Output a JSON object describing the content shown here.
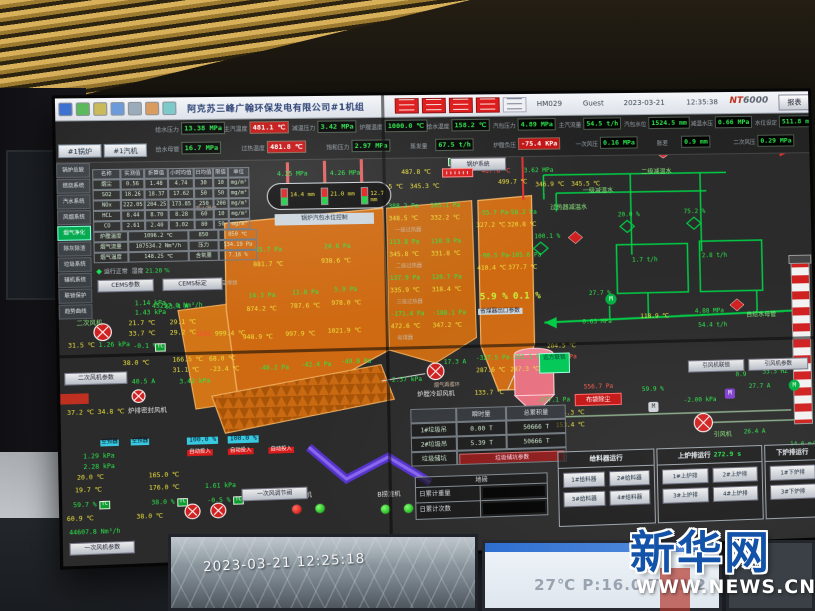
{
  "photo": {
    "camera_timestamp": "2023-03-21 12:25:18",
    "ambient_display": "27℃ P:16.0 T:17.2",
    "watermark_cn": "新华网",
    "watermark_url": "WWW.NEWS.CN"
  },
  "bar": {
    "title": "阿克苏三峰广翰环保发电有限公司#1机组",
    "station": "HM029",
    "user": "Guest",
    "date": "2023-03-21",
    "time": "12:35:38",
    "logo_a": "NT",
    "logo_b": "6000",
    "report": "报表"
  },
  "tabs": [
    "#1锅炉",
    "#1汽机"
  ],
  "menu": {
    "items": [
      "锅炉总貌",
      "燃烧系统",
      "汽水系统",
      "风烟系统",
      "烟气净化",
      "除灰除渣",
      "垃圾系统",
      "辅机系统",
      "联锁保护",
      "趋势曲线"
    ],
    "active_index": 4
  },
  "kpi": {
    "row1": [
      {
        "x": 92,
        "l": "给水压力",
        "v": "13.38 MPa"
      },
      {
        "x": 156,
        "l": "主汽温度",
        "v": "481.1 ℃",
        "a": true
      },
      {
        "x": 220,
        "l": "减温压力",
        "v": "3.42 MPa"
      },
      {
        "x": 284,
        "l": "炉膛温度",
        "v": "1000.0 ℃"
      },
      {
        "x": 348,
        "l": "给水温度",
        "v": "158.2 ℃"
      },
      {
        "x": 412,
        "l": "汽包压力",
        "v": "4.89 MPa"
      },
      {
        "x": 476,
        "l": "主汽流量",
        "v": "54.5 t/h"
      },
      {
        "x": 540,
        "l": "汽包水位",
        "v": "1524.5 mm"
      },
      {
        "x": 606,
        "l": "减温水压",
        "v": "0.66 MPa"
      },
      {
        "x": 670,
        "l": "水位设定",
        "v": "511.8 mm"
      }
    ],
    "row2": [
      {
        "x": 92,
        "l": "给水母管",
        "v": "16.7 MPa"
      },
      {
        "x": 172,
        "l": "过热温度",
        "v": "481.8 ℃",
        "a": true
      },
      {
        "x": 252,
        "l": "饱和压力",
        "v": "2.97 MPa"
      },
      {
        "x": 332,
        "l": "蒸发量",
        "v": "67.5 t/h"
      },
      {
        "x": 412,
        "l": "炉膛负压",
        "v": "-75.4 KPa",
        "a": true
      },
      {
        "x": 492,
        "l": "一次风压",
        "v": "0.16 MPa"
      },
      {
        "x": 572,
        "l": "胀差",
        "v": "0.9 mm"
      },
      {
        "x": 648,
        "l": "二次风压",
        "v": "0.29 MPa"
      }
    ]
  },
  "cems": {
    "head": [
      "名称",
      "实测值",
      "折算值",
      "小时均值",
      "日均值",
      "限值",
      "单位"
    ],
    "rows": [
      [
        "烟尘",
        "0.56",
        "1.48",
        "4.74",
        "30",
        "10",
        "mg/m³"
      ],
      [
        "SO2",
        "18.26",
        "18.37",
        "17.62",
        "50",
        "50",
        "mg/m³"
      ],
      [
        "NOx",
        "222.05",
        "204.25",
        "173.85",
        "250",
        "200",
        "mg/m³"
      ],
      [
        "HCL",
        "8.44",
        "8.70",
        "8.28",
        "60",
        "10",
        "mg/m³"
      ],
      [
        "CO",
        "2.61",
        "2.40",
        "3.02",
        "80",
        "50",
        "mg/m³"
      ]
    ],
    "extra": [
      [
        "炉膛温度",
        "1096.2 ℃",
        "850",
        "850 ℃"
      ],
      [
        "烟气流量",
        "107534.2 Nm³/h",
        "压力",
        "134.19 Pa"
      ],
      [
        "烟气温度",
        "148.25 ℃",
        "含氧量",
        "7.16 %"
      ]
    ],
    "status": "运行正常",
    "humidity_label": "湿度",
    "humidity": "21.28 %",
    "btn1": "CEMS参数",
    "btn2": "CEMS标定"
  },
  "boiler": {
    "sys_btn": "锅炉系统",
    "drum_label": "锅炉汽包水位控制",
    "drum": [
      {
        "v": "14.4 mm"
      },
      {
        "v": "21.0 mm"
      },
      {
        "v": "12.7 mm"
      }
    ],
    "remote": "远方联锁"
  },
  "trash": {
    "head": [
      "",
      "瞬时量",
      "总累积量"
    ],
    "rows": [
      [
        "1#垃圾吊",
        "0.00 T",
        "50666 T"
      ],
      [
        "2#垃圾吊",
        "5.39 T",
        "50666 T"
      ]
    ],
    "pit": "垃圾储坑",
    "pit_btn": "垃圾储坑参数",
    "scale_title": "地磅",
    "s1": "日累计重量",
    "s2": "日累计次数"
  },
  "run": {
    "t1": "给料器运行",
    "t2": "上炉排运行",
    "t2v": "272.9 s",
    "t3": "下炉排运行",
    "feeders": [
      "1#给料器",
      "2#给料器",
      "3#给料器",
      "4#给料器"
    ],
    "upper": [
      "1#上炉排",
      "2#上炉排",
      "3#上炉排",
      "4#上炉排"
    ],
    "lower": [
      "1#下炉排",
      "3#下炉排"
    ]
  },
  "buttons": {
    "saf": "二次风机参数",
    "paf": "一次风机参数",
    "pav": "一次风调节阀",
    "idf1": "引风机联锁",
    "idf2": "引风机参数"
  },
  "icons": {
    "motor": "M",
    "t": "T",
    "c": "C"
  },
  "scatter": [
    [
      205,
      73,
      "g",
      "4.25 MPa"
    ],
    [
      255,
      73,
      "g",
      "4.26 MPa"
    ],
    [
      323,
      73,
      "y",
      "487.8 ℃"
    ],
    [
      400,
      73,
      "r",
      "487.8 ℃"
    ],
    [
      441,
      73,
      "g",
      "3.62 MPa"
    ],
    [
      296,
      87,
      "y",
      "353.5 ℃"
    ],
    [
      331,
      87,
      "y",
      "345.3 ℃"
    ],
    [
      416,
      84,
      "y",
      "499.7 ℃"
    ],
    [
      452,
      87,
      "y",
      "346.9 ℃"
    ],
    [
      487,
      87,
      "y",
      "345.5 ℃"
    ],
    [
      183,
      146,
      "g",
      "55.7 Pa"
    ],
    [
      248,
      144,
      "g",
      "24.8 Pa"
    ],
    [
      181,
      160,
      "y",
      "881.7 ℃"
    ],
    [
      245,
      158,
      "y",
      "938.6 ℃"
    ],
    [
      176,
      190,
      "g",
      "14.3 Pa"
    ],
    [
      217,
      188,
      "g",
      "11.8 Pa"
    ],
    [
      257,
      186,
      "g",
      "5.9 Pa"
    ],
    [
      174,
      203,
      "y",
      "874.2 ℃"
    ],
    [
      215,
      201,
      "y",
      "787.6 ℃"
    ],
    [
      254,
      199,
      "y",
      "978.0 ℃"
    ],
    [
      170,
      230,
      "y",
      "948.9 ℃"
    ],
    [
      210,
      228,
      "y",
      "997.9 ℃"
    ],
    [
      250,
      226,
      "y",
      "1021.9 ℃"
    ],
    [
      184,
      260,
      "g",
      "-46.2 Pa"
    ],
    [
      224,
      258,
      "g",
      "-42.4 Pa"
    ],
    [
      262,
      256,
      "g",
      "-49.8 Pa"
    ],
    [
      126,
      226,
      "r",
      "1501"
    ],
    [
      144,
      226,
      "y",
      "999.4 ℃"
    ],
    [
      86,
      198,
      "g",
      "45257.0 Nm³/h"
    ],
    [
      128,
      106,
      "gl",
      "观火摄像"
    ],
    [
      146,
      178,
      "gl",
      "紧急排放"
    ],
    [
      310,
      106,
      "g",
      "388.2 Pa"
    ],
    [
      350,
      106,
      "g",
      "105.1 Pa"
    ],
    [
      310,
      118,
      "y",
      "348.5 ℃"
    ],
    [
      350,
      118,
      "y",
      "332.2 ℃"
    ],
    [
      316,
      130,
      "gl",
      "一级过热器"
    ],
    [
      310,
      141,
      "g",
      "113.8 Pa"
    ],
    [
      350,
      141,
      "g",
      "110.9 Pa"
    ],
    [
      310,
      153,
      "y",
      "345.8 ℃"
    ],
    [
      350,
      153,
      "y",
      "331.8 ℃"
    ],
    [
      316,
      165,
      "gl",
      "二级过热器"
    ],
    [
      310,
      176,
      "g",
      "137.9 Pa"
    ],
    [
      350,
      176,
      "g",
      "120.7 Pa"
    ],
    [
      310,
      188,
      "y",
      "335.9 ℃"
    ],
    [
      350,
      188,
      "y",
      "318.4 ℃"
    ],
    [
      316,
      200,
      "gl",
      "三级过热器"
    ],
    [
      310,
      211,
      "g",
      "-171.4 Pa"
    ],
    [
      350,
      211,
      "g",
      "-188.1 Pa"
    ],
    [
      310,
      223,
      "y",
      "472.6 ℃"
    ],
    [
      350,
      223,
      "y",
      "347.2 ℃"
    ],
    [
      316,
      235,
      "gl",
      "省煤器"
    ],
    [
      396,
      114,
      "g",
      "-55.7 Pa"
    ],
    [
      424,
      114,
      "g",
      "-58.2 Pa"
    ],
    [
      394,
      126,
      "y",
      "327.2 ℃"
    ],
    [
      424,
      126,
      "y",
      "320.8 ℃"
    ],
    [
      396,
      156,
      "g",
      "-90.5 Pa"
    ],
    [
      424,
      156,
      "g",
      "-105.6 Pa"
    ],
    [
      394,
      168,
      "y",
      "410.4 ℃"
    ],
    [
      424,
      168,
      "y",
      "377.7 ℃"
    ],
    [
      396,
      194,
      "o2",
      "5.9 %"
    ],
    [
      428,
      194,
      "o2",
      "0.1 %"
    ],
    [
      394,
      210,
      "lbox",
      "省煤器出口参数"
    ],
    [
      391,
      256,
      "g",
      "-327.5 Pa"
    ],
    [
      424,
      256,
      "g",
      "-351.1 Pa"
    ],
    [
      391,
      268,
      "y",
      "287.6 ℃"
    ],
    [
      424,
      268,
      "y",
      "287.3 ℃"
    ],
    [
      350,
      282,
      "gl",
      "烟气再循环"
    ],
    [
      446,
      54,
      "g",
      "3.51 MPa"
    ],
    [
      489,
      54,
      "g",
      "68.6 t/h"
    ],
    [
      532,
      54,
      "y",
      "406.6 ℃"
    ],
    [
      650,
      53,
      "pl",
      "去汽机"
    ],
    [
      556,
      76,
      "pl",
      "二级减温水"
    ],
    [
      498,
      94,
      "pl",
      "一级减温水"
    ],
    [
      466,
      110,
      "pl",
      "过热器减温水"
    ],
    [
      450,
      138,
      "g",
      "100.1 %"
    ],
    [
      532,
      118,
      "g",
      "20.0 %"
    ],
    [
      597,
      116,
      "g",
      "75.2 %"
    ],
    [
      545,
      163,
      "g",
      "1.7 t/h"
    ],
    [
      614,
      160,
      "g",
      "2.8 t/h"
    ],
    [
      495,
      223,
      "g",
      "0.63 MPa"
    ],
    [
      552,
      219,
      "y",
      "118.9 ℃"
    ],
    [
      606,
      215,
      "g",
      "4.88 MPa"
    ],
    [
      609,
      229,
      "g",
      "54.4 t/h"
    ],
    [
      502,
      195,
      "g",
      "27.7 %"
    ],
    [
      657,
      220,
      "pl",
      "自给水母管"
    ],
    [
      460,
      246,
      "y",
      "204.5 ℃"
    ],
    [
      460,
      257,
      "rv",
      "400.6 Pa"
    ],
    [
      389,
      290,
      "y",
      "133.7 ℃"
    ],
    [
      449,
      299,
      "g",
      "-377.1 Pa"
    ],
    [
      467,
      312,
      "y",
      "154.3 ℃"
    ],
    [
      467,
      324,
      "y",
      "153.4 ℃"
    ],
    [
      698,
      350,
      "g",
      "14.6 m/s"
    ],
    [
      360,
      259,
      "g",
      "17.3 A"
    ],
    [
      310,
      275,
      "g",
      "2.37 kPa"
    ],
    [
      334,
      290,
      "w",
      "炉膛冷却风机"
    ],
    [
      552,
      291,
      "g",
      "59.9 %"
    ],
    [
      495,
      287,
      "rv",
      "556.7 Pa"
    ],
    [
      593,
      303,
      "g",
      "-2.00 kPa"
    ],
    [
      645,
      279,
      "g",
      "0.9"
    ],
    [
      672,
      277,
      "g",
      "33.3 HZ"
    ],
    [
      658,
      291,
      "g",
      "27.7 A"
    ],
    [
      622,
      338,
      "pl",
      "引风机"
    ],
    [
      652,
      336,
      "g",
      "26.4 A"
    ],
    [
      698,
      288,
      "mi",
      "M"
    ],
    [
      634,
      295,
      "mi2",
      "M"
    ],
    [
      558,
      306,
      "mi3",
      "M"
    ],
    [
      518,
      198,
      "mi",
      "M"
    ],
    [
      368,
      62,
      "tc",
      "T"
    ],
    [
      382,
      62,
      "tc",
      "C"
    ],
    [
      16,
      213,
      "pl",
      "二次风机"
    ],
    [
      98,
      199,
      "g",
      "63.4 A"
    ],
    [
      70,
      195,
      "g",
      "1.14 kPa"
    ],
    [
      70,
      204,
      "g",
      "1.43 kPa"
    ],
    [
      64,
      214,
      "y",
      "21.7 ℃"
    ],
    [
      64,
      224,
      "y",
      "33.7 ℃"
    ],
    [
      102,
      214,
      "y",
      "29.1 ℃"
    ],
    [
      102,
      224,
      "y",
      "29.2 ℃"
    ],
    [
      8,
      234,
      "y",
      "31.5 ℃"
    ],
    [
      36,
      234,
      "g",
      "1.26 kPa"
    ],
    [
      68,
      236,
      "g",
      "-0.1 %"
    ],
    [
      88,
      236,
      "tc",
      "TC"
    ],
    [
      58,
      252,
      "y",
      "38.0 ℃"
    ],
    [
      104,
      250,
      "y",
      "166.5 ℃"
    ],
    [
      104,
      260,
      "y",
      "31.1 ℃"
    ],
    [
      138,
      250,
      "y",
      "68.0 ℃"
    ],
    [
      138,
      260,
      "y",
      "-23.4 ℃"
    ],
    [
      110,
      271,
      "g",
      "3.42 kPa"
    ],
    [
      66,
      270,
      "g",
      "40.5 A"
    ],
    [
      6,
      298,
      "y",
      "37.2 ℃"
    ],
    [
      34,
      298,
      "y",
      "34.8 ℃"
    ],
    [
      62,
      298,
      "w",
      "炉排密封风机"
    ],
    [
      36,
      327,
      "cy",
      "空预器"
    ],
    [
      64,
      327,
      "cy",
      "空预器"
    ],
    [
      20,
      340,
      "g",
      "1.29 kPa"
    ],
    [
      20,
      350,
      "g",
      "2.28 kPa"
    ],
    [
      14,
      360,
      "y",
      "20.0 ℃"
    ],
    [
      12,
      372,
      "y",
      "19.7 ℃"
    ],
    [
      80,
      360,
      "y",
      "165.0 ℃"
    ],
    [
      80,
      372,
      "y",
      "176.0 ℃"
    ],
    [
      132,
      372,
      "g",
      "1.61 kPa"
    ],
    [
      10,
      386,
      "g",
      "59.7 %"
    ],
    [
      82,
      386,
      "g",
      "38.0 %"
    ],
    [
      134,
      386,
      "g",
      "-0.5 %"
    ],
    [
      34,
      385,
      "tc",
      "TC"
    ],
    [
      106,
      385,
      "tc",
      "TC"
    ],
    [
      158,
      385,
      "tc",
      "TC"
    ],
    [
      4,
      399,
      "y",
      "60.9 ℃"
    ],
    [
      68,
      399,
      "y",
      "38.0 ℃"
    ],
    [
      6,
      412,
      "g",
      "44607.8 Nm³/h"
    ],
    [
      116,
      327,
      "cyb",
      "100.0 %"
    ],
    [
      154,
      327,
      "cyb",
      "100.0 %"
    ],
    [
      116,
      339,
      "rb",
      "自动投入"
    ],
    [
      154,
      339,
      "rb",
      "自动投入"
    ],
    [
      192,
      339,
      "rb",
      "自动投入"
    ],
    [
      210,
      384,
      "w",
      "A捞渣机"
    ],
    [
      294,
      386,
      "w",
      "B捞渣机"
    ]
  ]
}
